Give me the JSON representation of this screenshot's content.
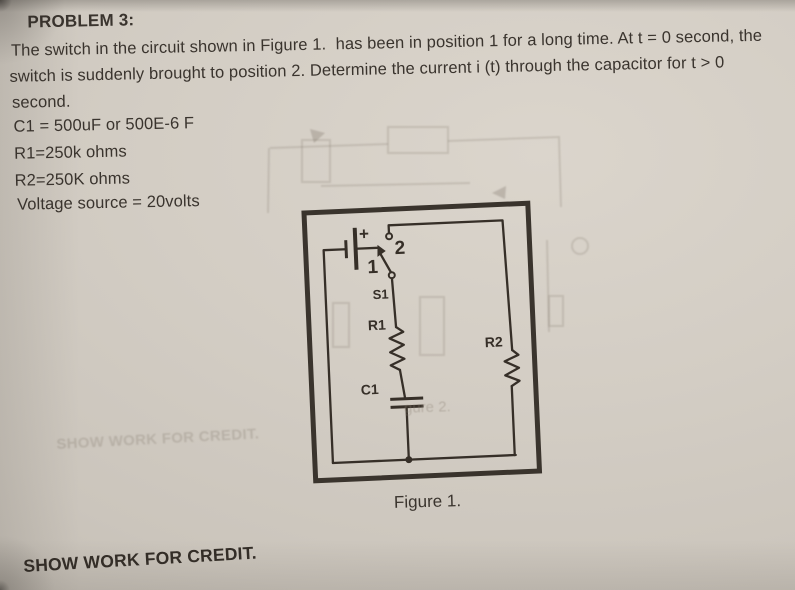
{
  "page": {
    "heading": "PROBLEM 3:",
    "body_lines": [
      "The switch in the circuit shown in Figure 1.  has been in position 1 for a long time. At t = 0 second, the",
      "switch is suddenly brought to position 2. Determine the current i (t) through the capacitor for t > 0",
      "second."
    ],
    "parameters": [
      "C1 = 500uF or 500E-6 F",
      "R1=250k ohms",
      "R2=250K ohms",
      "Voltage source = 20volts"
    ],
    "footer_note": "SHOW WORK FOR CREDIT."
  },
  "figure": {
    "caption": "Figure 1.",
    "labels": {
      "battery_plus": "+",
      "position_2": "2",
      "position_1": "1",
      "switch": "S1",
      "resistor_1": "R1",
      "capacitor": "C1",
      "resistor_2": "R2"
    }
  },
  "bleed_through": {
    "watermark": "SHOW WORK FOR CREDIT.",
    "figure2_fragment": "gure 2."
  },
  "colors": {
    "paper": "#d2ccc3",
    "ink": "#3a342e",
    "circuit_ink": "#362f28"
  }
}
